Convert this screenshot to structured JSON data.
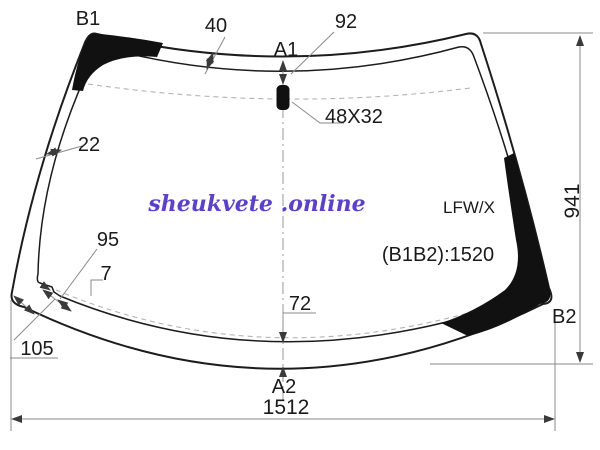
{
  "watermark": {
    "text": "sheukvete .online",
    "color": "#5b3fd4"
  },
  "part": {
    "model_code": "LFW/X",
    "b1b2_note": "(B1B2):1520",
    "sensor_size": "48X32"
  },
  "points": {
    "b1": "B1",
    "a1": "A1",
    "a2": "A2",
    "b2": "B2"
  },
  "dimensions": {
    "top_band_width": "40",
    "sensor_offset_from_top": "92",
    "left_band_width": "22",
    "lower_left_notch_length": "95",
    "lower_left_notch_step": "7",
    "lower_left_corner": "105",
    "bottom_band_width": "72",
    "overall_width": "1512",
    "overall_height": "941"
  },
  "colors": {
    "line": "#1c1c1c",
    "dimension_line": "#8a8a8a",
    "band_fill": "#111111",
    "background": "#ffffff"
  }
}
